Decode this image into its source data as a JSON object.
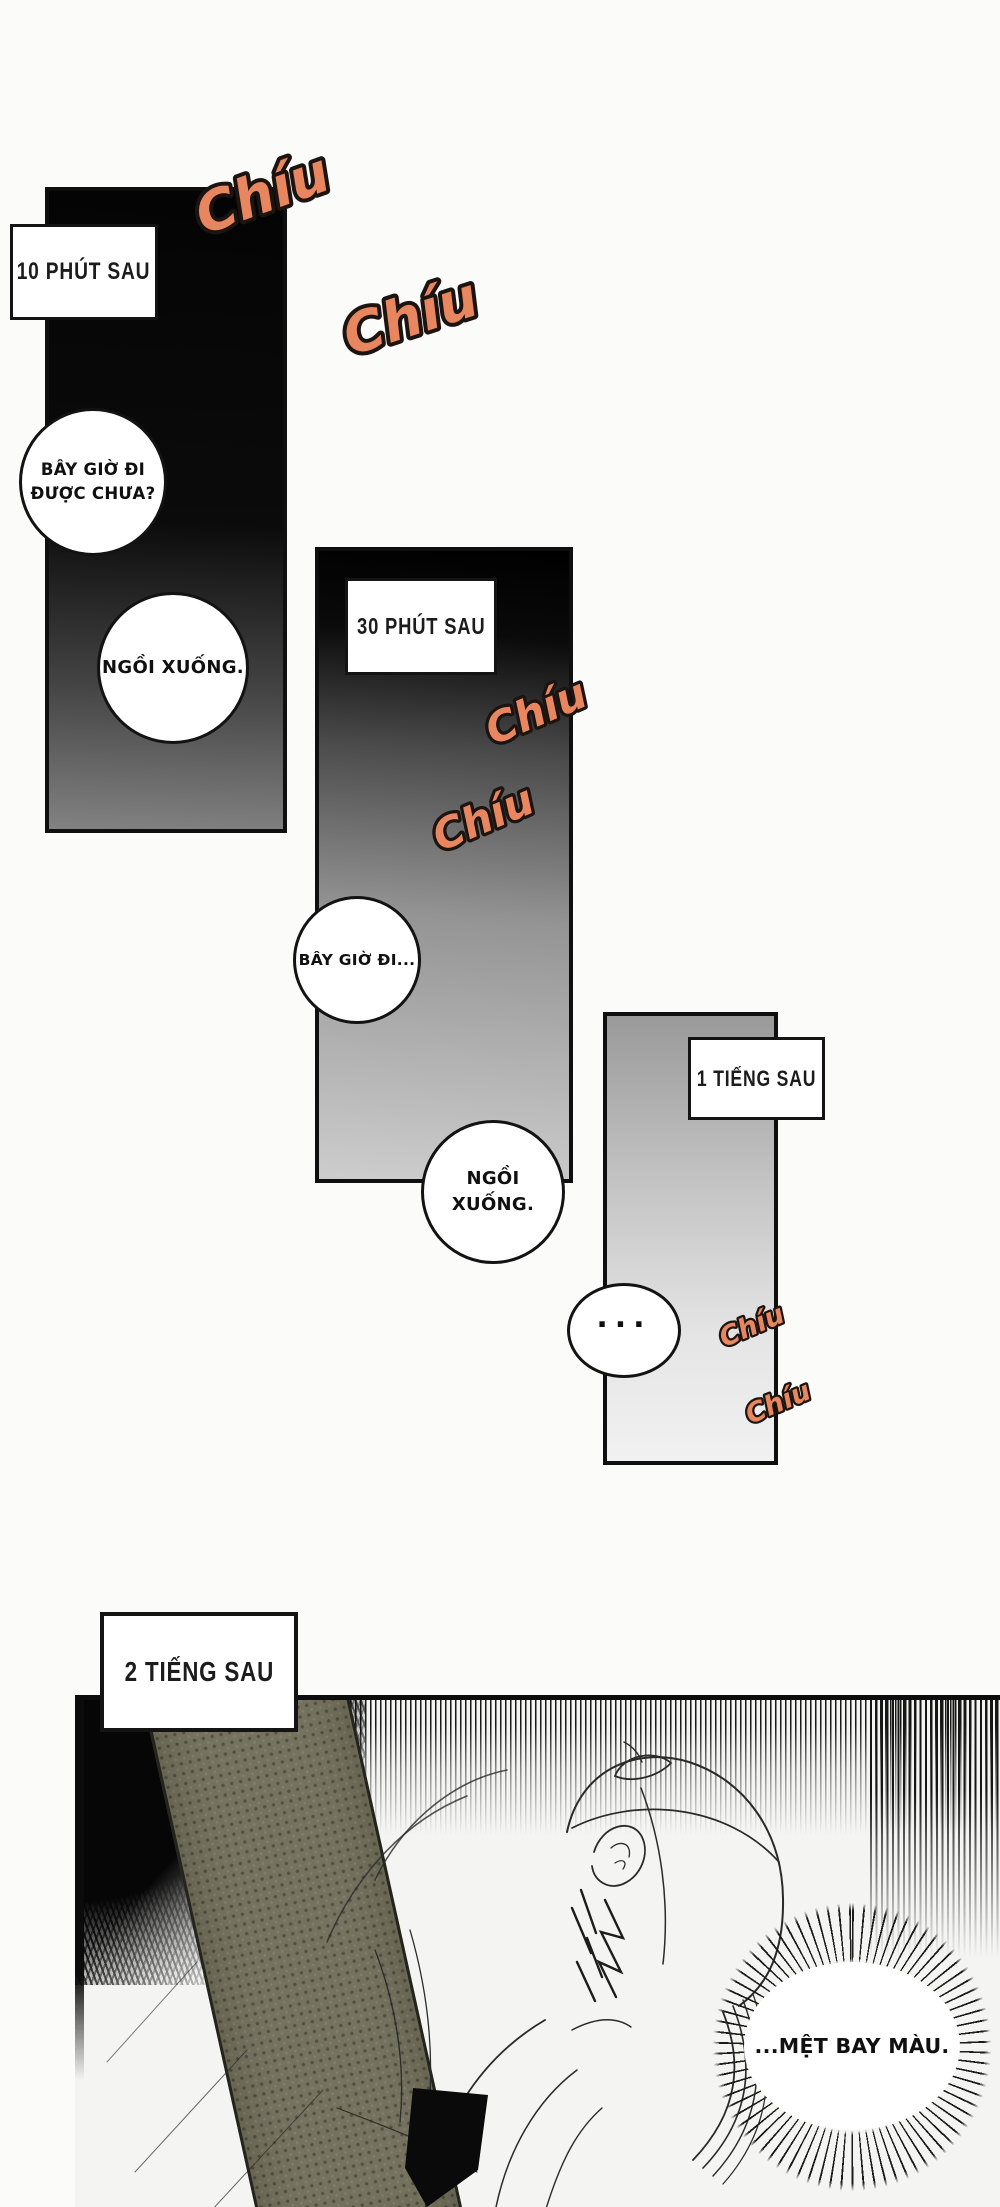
{
  "page": {
    "background": "#fbfbfa",
    "panel_border_color": "#0f0f0f"
  },
  "captions": {
    "panel1": "10 PHÚT SAU",
    "panel2": "30 PHÚT SAU",
    "panel3": "1 TIẾNG SAU",
    "panel4": "2 TIẾNG SAU"
  },
  "bubbles": {
    "p1_top_line1": "BÂY GIỜ ĐI",
    "p1_top_line2": "ĐƯỢC CHƯA?",
    "p1_bottom": "NGỒI XUỐNG.",
    "p2_top": "BÂY GIỜ ĐI...",
    "p2_bottom": "NGỒI XUỐNG.",
    "p3_dots": "...",
    "p4_burst": "...MỆT BAY MÀU."
  },
  "sfx": {
    "text": "Chíu",
    "fill": "#e8875f",
    "outline": "#1c1410"
  },
  "illustration": {
    "knit_band_color": "#75735f",
    "ink_color": "#2a2a2a"
  }
}
